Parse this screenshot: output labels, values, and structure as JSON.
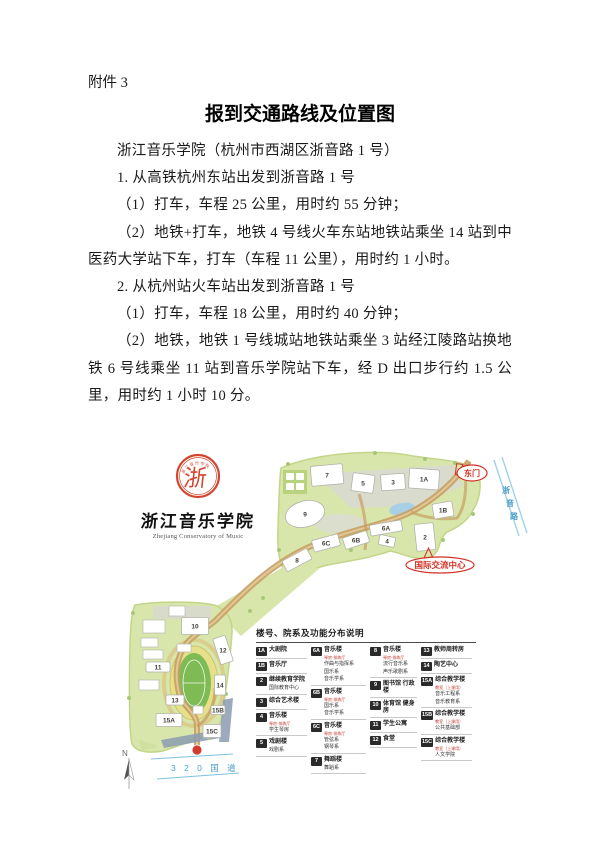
{
  "document": {
    "attachment_label": "附件 3",
    "title": "报到交通路线及位置图",
    "paragraphs": [
      "浙江音乐学院（杭州市西湖区浙音路 1 号）",
      "1. 从高铁杭州东站出发到浙音路 1 号",
      "（1）打车，车程 25 公里，用时约 55 分钟；",
      "（2）地铁+打车，地铁 4 号线火车东站地铁站乘坐 14 站到中医药大学站下车，打车（车程 11 公里），用时约 1 小时。",
      "2. 从杭州站火车站出发到浙音路 1 号",
      "（1）打车，车程 18 公里，用时约 40 分钟；",
      "（2）地铁，地铁 1 号线城站地铁站乘坐 3 站经江陵路站换地铁 6 号线乘坐 11 站到音乐学院站下车，经 D 出口步行约 1.5 公里，用时约 1 小时 10 分。"
    ]
  },
  "map": {
    "logo": {
      "seal_char": "浙",
      "seal_ring_text": "浙江音乐学院",
      "name_cn": "浙江音乐学院",
      "name_en": "Zhejiang Conservatory of Music"
    },
    "labels": {
      "east_gate": "东门",
      "zheyin_road_chars": [
        "浙",
        "音",
        "路"
      ],
      "intl_center": "国际交流中心",
      "national_road": "3 2 0 国 道",
      "north": "N"
    },
    "colors": {
      "campus_green": "#d9e6ab",
      "road_tan": "#c89e62",
      "field_green": "#7fbb55",
      "water_blue": "#a9cfe5",
      "red_accent": "#cf3126",
      "road_blue_text": "#4a9cc9"
    },
    "buildings": [
      {
        "label": "7",
        "x": 214,
        "y": 27,
        "w": 32,
        "h": 20,
        "r": -5
      },
      {
        "label": "5",
        "x": 250,
        "y": 35,
        "w": 22,
        "h": 18,
        "r": 8
      },
      {
        "label": "3",
        "x": 280,
        "y": 34,
        "w": 24,
        "h": 16,
        "r": -4
      },
      {
        "label": "1A",
        "x": 311,
        "y": 31,
        "w": 30,
        "h": 20,
        "r": 4
      },
      {
        "label": "1B",
        "x": 330,
        "y": 62,
        "w": 20,
        "h": 15,
        "r": -10
      },
      {
        "label": "9",
        "x": 192,
        "y": 66,
        "shape": "ellipse",
        "rx": 20,
        "ry": 13,
        "r": -15
      },
      {
        "label": "6A",
        "x": 273,
        "y": 80,
        "w": 32,
        "h": 11,
        "r": -10
      },
      {
        "label": "2",
        "x": 312,
        "y": 89,
        "w": 19,
        "h": 27,
        "r": -6
      },
      {
        "label": "4",
        "x": 274,
        "y": 93,
        "w": 16,
        "h": 10,
        "r": 12
      },
      {
        "label": "6B",
        "x": 243,
        "y": 92,
        "w": 25,
        "h": 12,
        "r": -18
      },
      {
        "label": "6C",
        "x": 213,
        "y": 95,
        "w": 27,
        "h": 12,
        "r": -15
      },
      {
        "label": "8",
        "x": 184,
        "y": 112,
        "w": 28,
        "h": 12,
        "r": -28
      },
      {
        "label": "10",
        "x": 82,
        "y": 178,
        "w": 27,
        "h": 17,
        "r": 0
      },
      {
        "label": "12",
        "x": 110,
        "y": 202,
        "w": 13,
        "h": 27,
        "r": -18
      },
      {
        "label": "11",
        "x": 45,
        "y": 219,
        "w": 24,
        "h": 10,
        "r": 0
      },
      {
        "label": "14",
        "x": 107,
        "y": 237,
        "w": 11,
        "h": 20,
        "r": 0
      },
      {
        "label": "13",
        "x": 62,
        "y": 252,
        "w": 18,
        "h": 10,
        "r": 0
      },
      {
        "label": "15B",
        "x": 105,
        "y": 262,
        "w": 14,
        "h": 9,
        "r": 0
      },
      {
        "label": "15A",
        "x": 56,
        "y": 272,
        "w": 26,
        "h": 13,
        "r": 0
      },
      {
        "label": "15C",
        "x": 99,
        "y": 283,
        "w": 18,
        "h": 13,
        "r": 0
      }
    ],
    "legend": {
      "title": "楼号、院系及功能分布说明",
      "columns": [
        [
          {
            "num": "1A",
            "title": "大剧院"
          },
          {
            "num": "1B",
            "title": "音乐厅"
          },
          {
            "num": "2",
            "title": "继续教育学院",
            "subs": [
              "国际教育中心"
            ]
          },
          {
            "num": "3",
            "title": "综合艺术楼"
          },
          {
            "num": "4",
            "title": "音乐楼",
            "note": "琴房·排练厅",
            "subs": [
              "学生琴房"
            ]
          },
          {
            "num": "5",
            "title": "戏剧楼",
            "subs": [
              "戏剧系"
            ]
          }
        ],
        [
          {
            "num": "6A",
            "title": "音乐楼",
            "note": "琴房·排练厅",
            "subs": [
              "作曲与指挥系",
              "国乐系",
              "音乐学系"
            ]
          },
          {
            "num": "6B",
            "title": "音乐楼",
            "note": "琴房·排练厅",
            "subs": [
              "国乐系",
              "音乐学系"
            ]
          },
          {
            "num": "6C",
            "title": "音乐楼",
            "note": "琴房·排练厅",
            "subs": [
              "管弦系",
              "钢琴系"
            ]
          },
          {
            "num": "7",
            "title": "舞蹈楼",
            "subs": [
              "舞蹈系"
            ]
          }
        ],
        [
          {
            "num": "8",
            "title": "音乐楼",
            "note": "琴房·排练厅",
            "subs": [
              "流行音乐系",
              "声乐歌剧系"
            ]
          },
          {
            "num": "9",
            "title": "图书馆 行政楼"
          },
          {
            "num": "10",
            "title": "体育馆 健身房"
          },
          {
            "num": "11",
            "title": "学生公寓"
          },
          {
            "num": "12",
            "title": "食堂"
          }
        ],
        [
          {
            "num": "13",
            "title": "教师周转房"
          },
          {
            "num": "14",
            "title": "陶艺中心"
          },
          {
            "num": "15A",
            "title": "综合教学楼",
            "note": "教室（上课用）",
            "subs": [
              "音乐工程系",
              "音乐教育系"
            ]
          },
          {
            "num": "15B",
            "title": "综合教学楼",
            "note": "教室（上课用）",
            "subs": [
              "公共基础部"
            ]
          },
          {
            "num": "15C",
            "title": "综合教学楼",
            "note": "教室（上课用）",
            "subs": [
              "人文学院"
            ]
          }
        ]
      ]
    }
  }
}
